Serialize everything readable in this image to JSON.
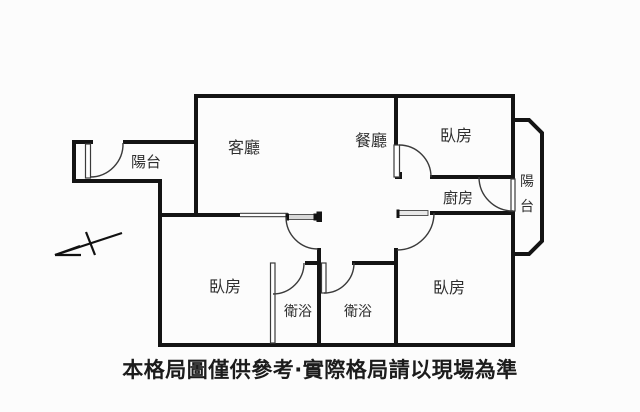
{
  "canvas": {
    "width": 640,
    "height": 412,
    "background": "#fcfcfc"
  },
  "colors": {
    "wall": "#141414",
    "thin_line": "#555555",
    "room_label": "#2e2e2e",
    "footer_text": "#1c1c1c"
  },
  "rooms": {
    "balcony_left": {
      "label": "陽台"
    },
    "living": {
      "label": "客廳"
    },
    "dining": {
      "label": "餐廳"
    },
    "bedroom_top": {
      "label": "臥房"
    },
    "balcony_right": {
      "label": "陽台",
      "char_top": "陽",
      "char_bottom": "台"
    },
    "kitchen": {
      "label": "廚房"
    },
    "bedroom_left": {
      "label": "臥房"
    },
    "bath_left": {
      "label": "衛浴"
    },
    "bath_right": {
      "label": "衛浴"
    },
    "bedroom_right": {
      "label": "臥房"
    }
  },
  "footer": {
    "disclaimer": "本格局圖僅供參考·實際格局請以現場為準"
  }
}
